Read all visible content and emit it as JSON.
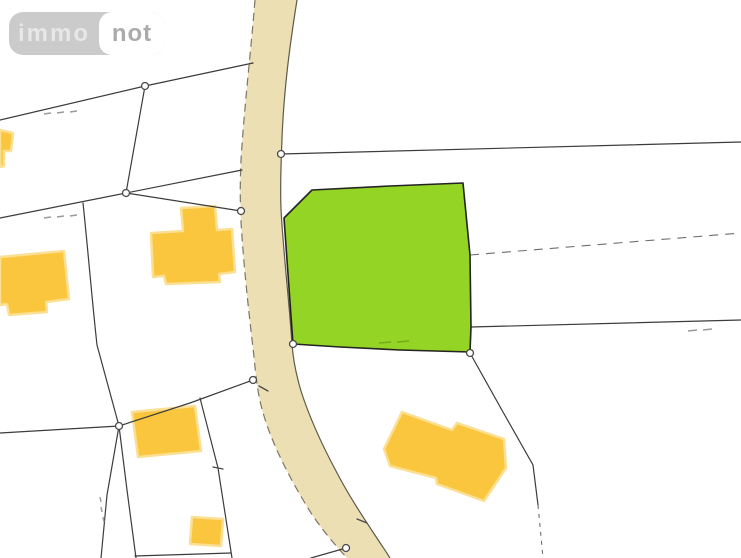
{
  "logo": {
    "part1": "immo",
    "part2": "not"
  },
  "colors": {
    "background": "#ffffff",
    "road_fill": "#ecdfb3",
    "road_edge_left": "#7c7664",
    "road_edge_right": "#5d594b",
    "parcel_highlight_fill": "#93d424",
    "parcel_highlight_outline": "#232323",
    "building_fill": "#f9c63e",
    "building_halo": "#fbdf92",
    "boundary_line": "#3c3c3c",
    "dashed_line": "#6e6e6e",
    "faint_mark": "#9a9a9a",
    "parcel_mark_green": "#74aa1d",
    "marker_fill": "#fdfdfd",
    "marker_ring": "#4a4a4a",
    "logo_bg": "#cbcbcb",
    "logo_text_immo": "#e7e7e7",
    "logo_not_bg": "#ffffff",
    "logo_text_not": "#ababab"
  },
  "map": {
    "kind": "cadastral parcel map",
    "highlighted_parcel": "green highlighted land parcel east of the road",
    "road": "curved road band crossing the map from top to bottom",
    "buildings_count": 6,
    "boundary_markers_count": 9
  }
}
